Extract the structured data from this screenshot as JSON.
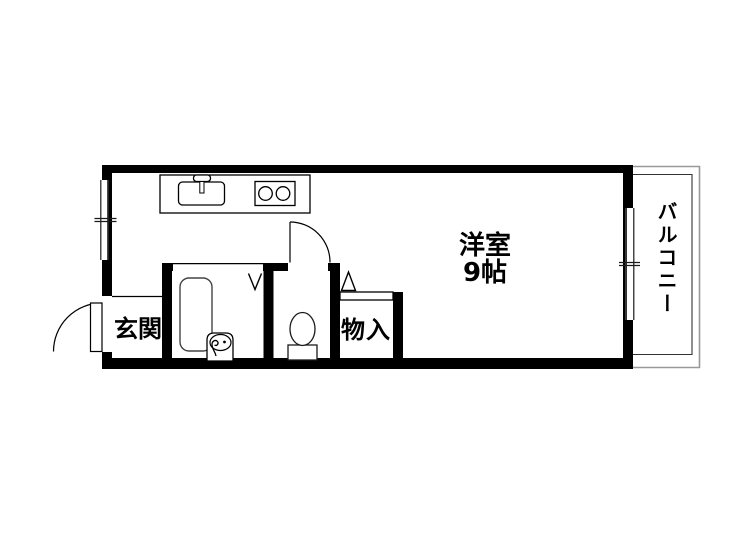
{
  "floorplan": {
    "type": "japanese-apartment-floor-plan",
    "rooms": {
      "entrance": {
        "label": "玄関"
      },
      "main_room": {
        "name_label": "洋室",
        "size_label": "9帖"
      },
      "storage": {
        "label": "物入"
      },
      "balcony": {
        "label": "バルコニー"
      }
    },
    "fixtures": {
      "kitchen_sink": "kitchen-sink-with-faucet-icon",
      "stove": "two-burner-stove-icon",
      "bathtub": "bathtub-icon",
      "washbasin": "washbasin-icon",
      "toilet": "toilet-icon",
      "door_marks": [
        "entrance-door-swing-arc",
        "toilet-door-swing-arc",
        "bathroom-folding-door-v-mark",
        "storage-opening-triangle-mark"
      ],
      "window_marks": [
        "left-wall-window",
        "balcony-wall-window"
      ]
    },
    "colors": {
      "wall": "#000000",
      "background": "#ffffff",
      "line": "#1a1a1a",
      "fixture_line": "#444444",
      "balcony_outer_line": "#999999",
      "balcony_inner_line": "#333333"
    }
  }
}
